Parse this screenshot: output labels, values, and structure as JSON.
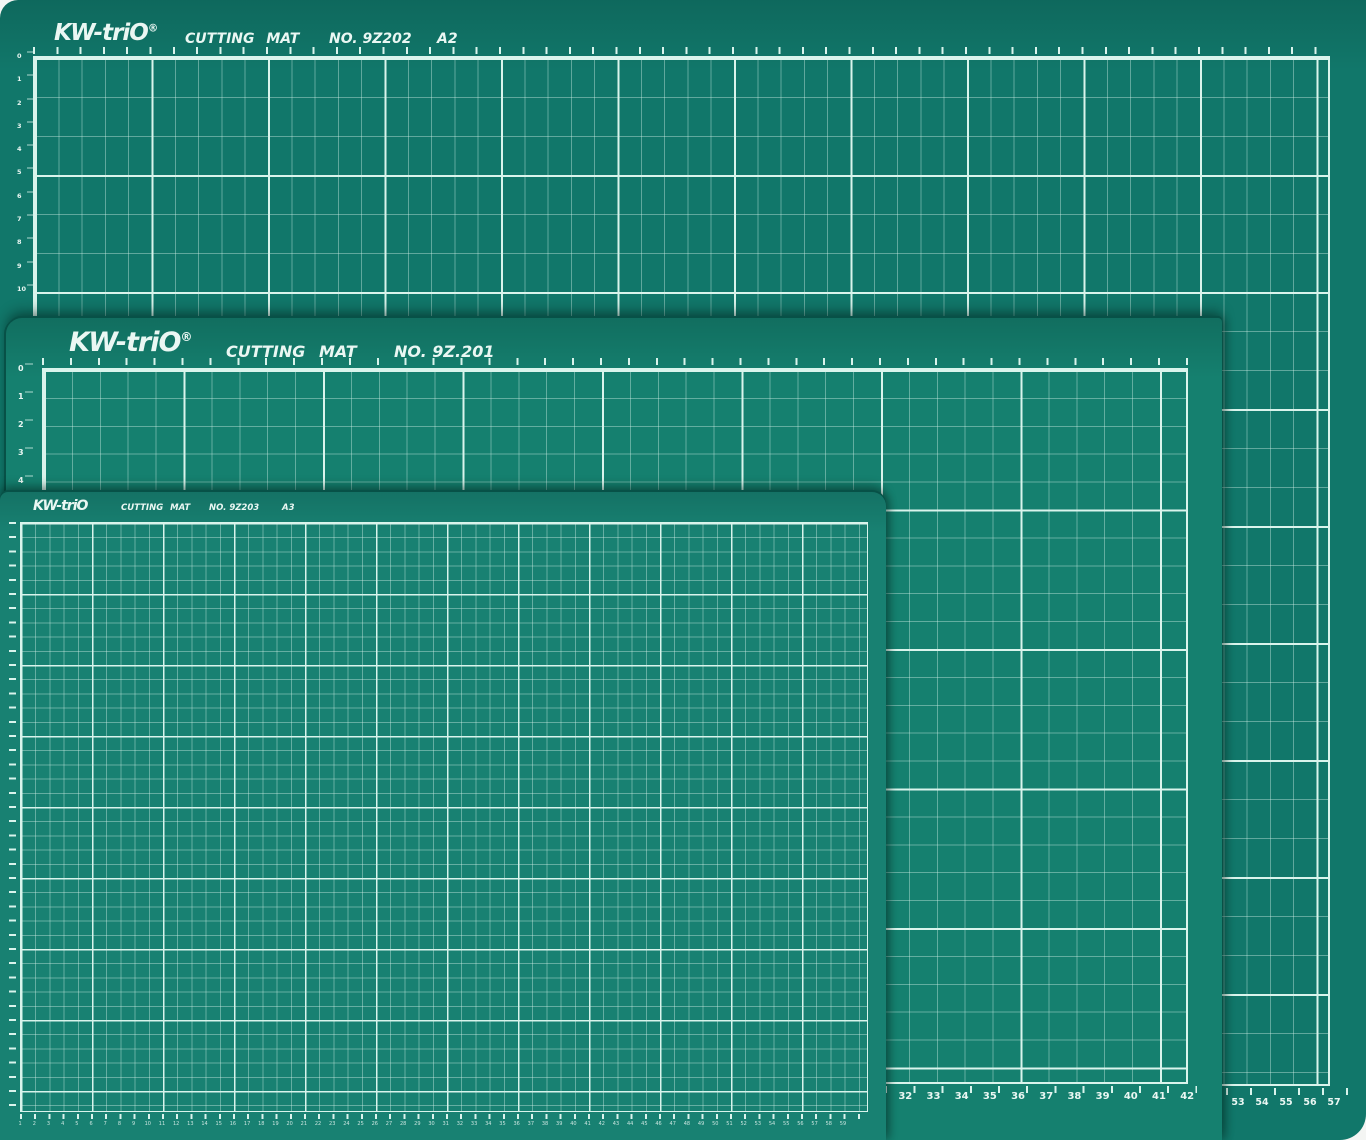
{
  "colors": {
    "photo-bg": "#f4f5f3",
    "mat-a2-bg": "#11776a",
    "mat-a1-bg": "#15806f",
    "mat-a3-bg": "#188172",
    "grid-minor": "rgba(214,242,234,0.40)",
    "grid-major": "#d9f4ec",
    "label-text": "#eaf7f3",
    "edge-dark": "#075147"
  },
  "mats": [
    {
      "brand": "KW-triO",
      "registered_mark": "®",
      "title": "CUTTING MAT",
      "model": "NO. 9Z202",
      "size": "A2",
      "bottom_ruler_numbers": [
        53,
        54,
        55,
        56,
        57
      ],
      "left_ruler_numbers": [
        0,
        1,
        2,
        3,
        4,
        5,
        6,
        7,
        8,
        9,
        10
      ]
    },
    {
      "brand": "KW-triO",
      "registered_mark": "®",
      "title": "CUTTING MAT",
      "model": "NO. 9Z.201",
      "size": "",
      "bottom_ruler_numbers": [
        31,
        32,
        33,
        34,
        35,
        36,
        37,
        38,
        39,
        40,
        41,
        42
      ],
      "left_ruler_numbers": [
        0,
        1,
        2,
        3,
        4
      ]
    },
    {
      "brand": "KW-triO",
      "registered_mark": "",
      "title": "CUTTING MAT",
      "model": "NO. 9Z203",
      "size": "A3",
      "bottom_ruler_numbers": [
        1,
        2,
        3,
        4,
        5,
        6,
        7,
        8,
        9,
        10,
        11,
        12,
        13,
        14,
        15,
        16,
        17,
        18,
        19,
        20,
        21,
        22,
        23,
        24,
        25,
        26,
        27,
        28,
        29,
        30,
        31,
        32,
        33,
        34,
        35,
        36,
        37,
        38,
        39,
        40,
        41,
        42,
        43,
        44,
        45,
        46,
        47,
        48,
        49,
        50,
        51,
        52,
        53,
        54,
        55,
        56,
        57,
        58,
        59
      ]
    }
  ]
}
